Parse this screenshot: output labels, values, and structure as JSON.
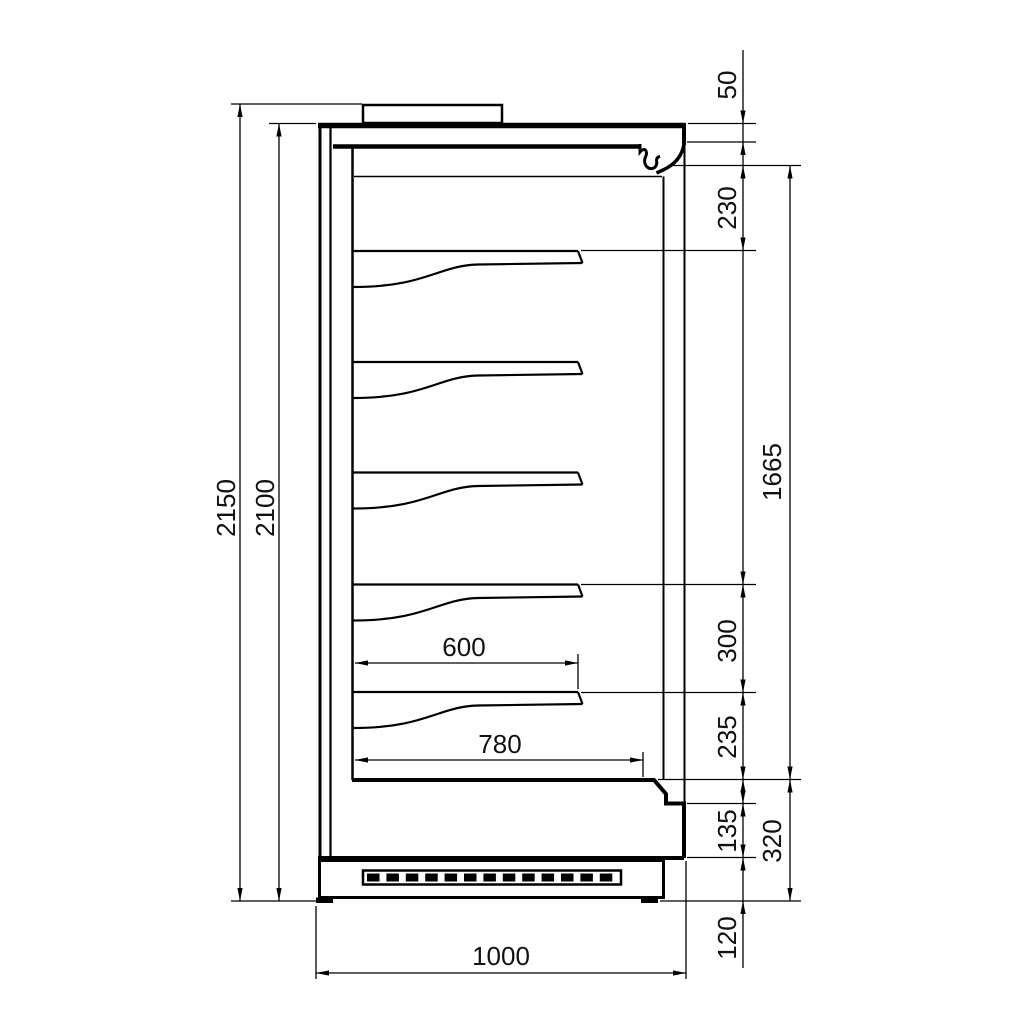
{
  "page": {
    "background": "#ffffff",
    "stroke_color": "#000000",
    "text_color": "#111111"
  },
  "drawing": {
    "subject": "Upright refrigerated wall cabinet - side section dimensional drawing (mm)",
    "shelf_count": 5,
    "dims": {
      "left": [
        {
          "id": "overall-height",
          "label": "2150"
        },
        {
          "id": "body-height",
          "label": "2100"
        }
      ],
      "right": [
        {
          "id": "top-gap",
          "label": "50"
        },
        {
          "id": "canopy-to-first-shelf",
          "label": "230"
        },
        {
          "id": "display-opening",
          "label": "1665"
        },
        {
          "id": "shelf-pitch",
          "label": "300"
        },
        {
          "id": "bottom-shelf-to-deck",
          "label": "235"
        },
        {
          "id": "lower-front-panel",
          "label": "135"
        },
        {
          "id": "base-zone",
          "label": "320"
        },
        {
          "id": "plinth-height",
          "label": "120"
        }
      ],
      "bottom": [
        {
          "id": "shelf-depth",
          "label": "600"
        },
        {
          "id": "deck-depth",
          "label": "780"
        },
        {
          "id": "overall-depth",
          "label": "1000"
        }
      ]
    }
  }
}
